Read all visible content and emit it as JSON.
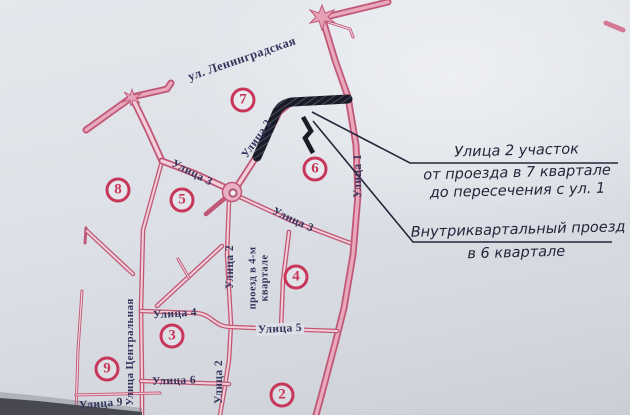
{
  "annotations": {
    "callout1": {
      "line1": "Улица 2 участок",
      "line2": "от проезда в 7 квартале",
      "line3": "до пересечения с ул. 1"
    },
    "callout2": {
      "line1": "Внутриквартальный проезд",
      "line2": "в 6 квартале"
    }
  },
  "map": {
    "street_labels": [
      {
        "id": "leningradskaya",
        "text": "ул. Ленинградская",
        "x": 242,
        "y": 59,
        "rot": -19,
        "size": 12.5
      },
      {
        "id": "ulitsa-2-upper",
        "text": "Улица 2",
        "x": 257,
        "y": 139,
        "rot": -55,
        "size": 11.5
      },
      {
        "id": "ulitsa-3-upper",
        "text": "Улица 3",
        "x": 192,
        "y": 173,
        "rot": 27,
        "size": 11.5
      },
      {
        "id": "ulitsa-3-lower",
        "text": "Улица 3",
        "x": 293,
        "y": 220,
        "rot": 25,
        "size": 11.5
      },
      {
        "id": "ulitsa-1",
        "text": "Улица 1",
        "x": 358,
        "y": 176,
        "rot": -90,
        "size": 11.5
      },
      {
        "id": "ulitsa-2-mid",
        "text": "Улица 2",
        "x": 230,
        "y": 267,
        "rot": -90,
        "size": 11.5
      },
      {
        "id": "proezd-4",
        "text": "проезд в 4-м",
        "text2": "квартале",
        "x": 259,
        "y": 278,
        "rot": -90,
        "size": 10.5
      },
      {
        "id": "ulitsa-4",
        "text": "Улица 4",
        "x": 175,
        "y": 314,
        "rot": -4,
        "size": 11.5
      },
      {
        "id": "ulitsa-5",
        "text": "Улица 5",
        "x": 280,
        "y": 329,
        "rot": -3,
        "size": 11.5,
        "bg": true
      },
      {
        "id": "ulitsa-6",
        "text": "Улица 6",
        "x": 174,
        "y": 381,
        "rot": -2,
        "size": 11.5
      },
      {
        "id": "ulitsa-2-lower",
        "text": "Улица 2",
        "x": 219,
        "y": 382,
        "rot": -90,
        "size": 11.5
      },
      {
        "id": "tsentralnaya",
        "text": "Улица Центральная",
        "x": 130,
        "y": 352,
        "rot": -90,
        "size": 11
      },
      {
        "id": "ulitsa-9",
        "text": "Улица 9",
        "x": 101,
        "y": 404,
        "rot": -5,
        "size": 11.5
      }
    ],
    "block_numbers": [
      {
        "n": "7",
        "x": 243,
        "y": 100
      },
      {
        "n": "8",
        "x": 118,
        "y": 190
      },
      {
        "n": "5",
        "x": 182,
        "y": 200
      },
      {
        "n": "6",
        "x": 315,
        "y": 169
      },
      {
        "n": "4",
        "x": 296,
        "y": 277
      },
      {
        "n": "3",
        "x": 172,
        "y": 336
      },
      {
        "n": "9",
        "x": 107,
        "y": 369
      },
      {
        "n": "2",
        "x": 282,
        "y": 395
      }
    ],
    "colors": {
      "road_casing": "#c05878",
      "road_fill": "#f2d0da",
      "highlight_ink": "#1b1b28",
      "block_crimson": "#c8365a",
      "paper": "#dde1e7"
    }
  }
}
